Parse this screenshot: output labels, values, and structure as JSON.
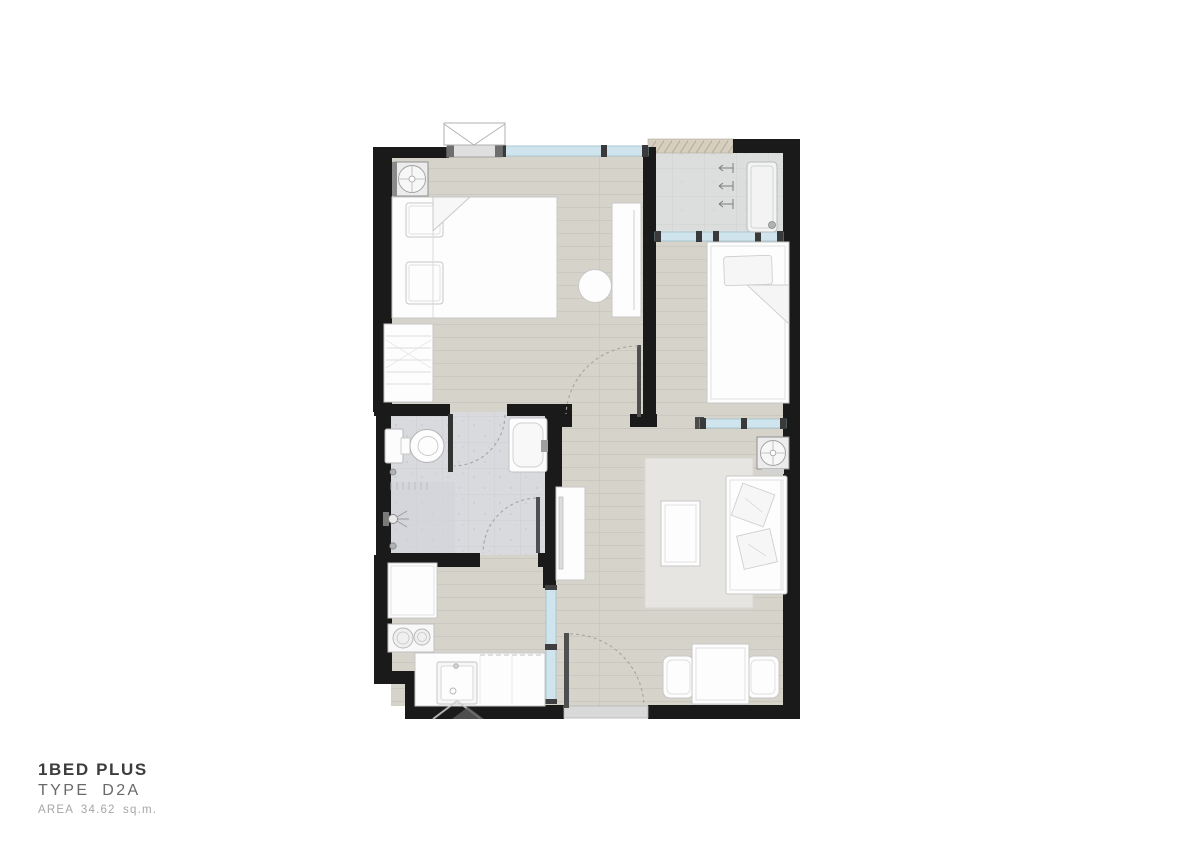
{
  "title_block": {
    "name": "1BED PLUS",
    "type": "TYPE D2A",
    "area": "AREA 34.62 sq.m."
  },
  "colors": {
    "wall": "#1a1a1a",
    "glass": "#cfe4ec",
    "wood_floor": "#d6d3cb",
    "wood_line": "#c8c5be",
    "bath_tile": "#d9dade",
    "shower_tile": "#d2d4d8",
    "balcony_tile": "#dcdedd",
    "hatch_strip": "#d6cfc0",
    "furniture": "#fdfdfd",
    "furniture_outline": "#c7c7c7",
    "rug": "#e7e5e1",
    "title_primary": "#3d3d3d",
    "title_secondary": "#696969",
    "title_tertiary": "#a6a6a6"
  },
  "plan_elements": [
    "queen-bed",
    "pillow",
    "wardrobe",
    "round-stool",
    "shelf-unit",
    "ac-unit",
    "single-bed",
    "balcony-bench",
    "plant-tap-symbol",
    "floor-drain",
    "toilet",
    "vanity-sink",
    "shower-head",
    "fridge",
    "stove-2-burner",
    "kitchen-sink",
    "kitchen-counter",
    "sliding-glass-partition",
    "tv-console",
    "area-rug",
    "coffee-table",
    "sofa",
    "sofa-cushion",
    "dining-table",
    "dining-chair",
    "entry-door",
    "bedroom-door",
    "bathroom-door",
    "window",
    "balcony",
    "watermark-logo"
  ]
}
